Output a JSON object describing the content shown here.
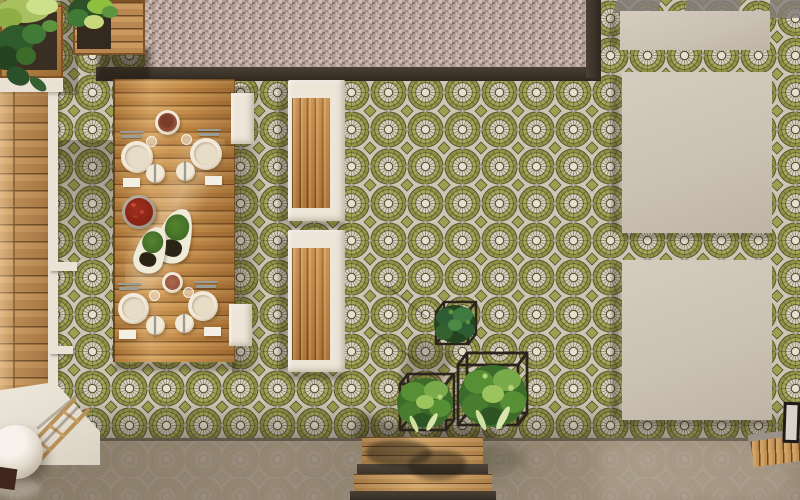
{
  "scene": {
    "title": "Top-down 3D render of an outdoor patio terrace",
    "view": "top-down",
    "ground": {
      "main_floor": "green circular mosaic tile pattern",
      "gravel_strip": "pink-grey pebble gravel band along top edge",
      "gravel_border": "dark brown edging strip around gravel",
      "glossy_floor": "polished reflective concrete band along bottom edge",
      "pavers": {
        "count": 3,
        "material": "large cream square concrete pavers",
        "position": "right side"
      }
    },
    "furniture": {
      "dining_table": {
        "material": "teak wood planks",
        "position": "left-center",
        "settings": 4
      },
      "benches": {
        "count": 2,
        "material": "white frame with vertical wood slats",
        "position": "center"
      },
      "stools": {
        "count": 2,
        "material": "white",
        "position": "right of table"
      },
      "deck_bench": {
        "material": "wood planks with white rim",
        "position": "left edge"
      }
    },
    "tableware": {
      "dinner_plates": 4,
      "side_plates": 4,
      "napkins": 4,
      "glasses": 4,
      "serving_bowls": 2,
      "salad_bowl_red": 1,
      "leaf_dishes": 2,
      "leaf_dish_contents": "green herbs and dark olives",
      "red_bowl_contents": "tomato salad"
    },
    "plants": {
      "wire_cube_planters": 3,
      "wire_cube_contents": "leafy green plants in black wire cube stands",
      "planter_boxes": 2,
      "planter_position": "top-left corner"
    },
    "decor": {
      "white_sphere_vase": 1,
      "wood_ladder": 1,
      "black_frame": 1,
      "wood_step_platform": "bottom center",
      "wood_walkway": "bottom right corner"
    },
    "palette": {
      "tile_green": "#9aa050",
      "tile_cream": "#d9cfbf",
      "tile_line": "#55512f",
      "gravel": "#b2a19b",
      "dark_edge": "#3e352b",
      "wood": "#c98f4e",
      "white_furniture": "#ece5d8",
      "paver": "#cdc3b6",
      "glossy_floor": "#968878",
      "plant_green": "#4a7a35",
      "food_red": "#8e2418",
      "terracotta": "#9c5a40"
    }
  }
}
